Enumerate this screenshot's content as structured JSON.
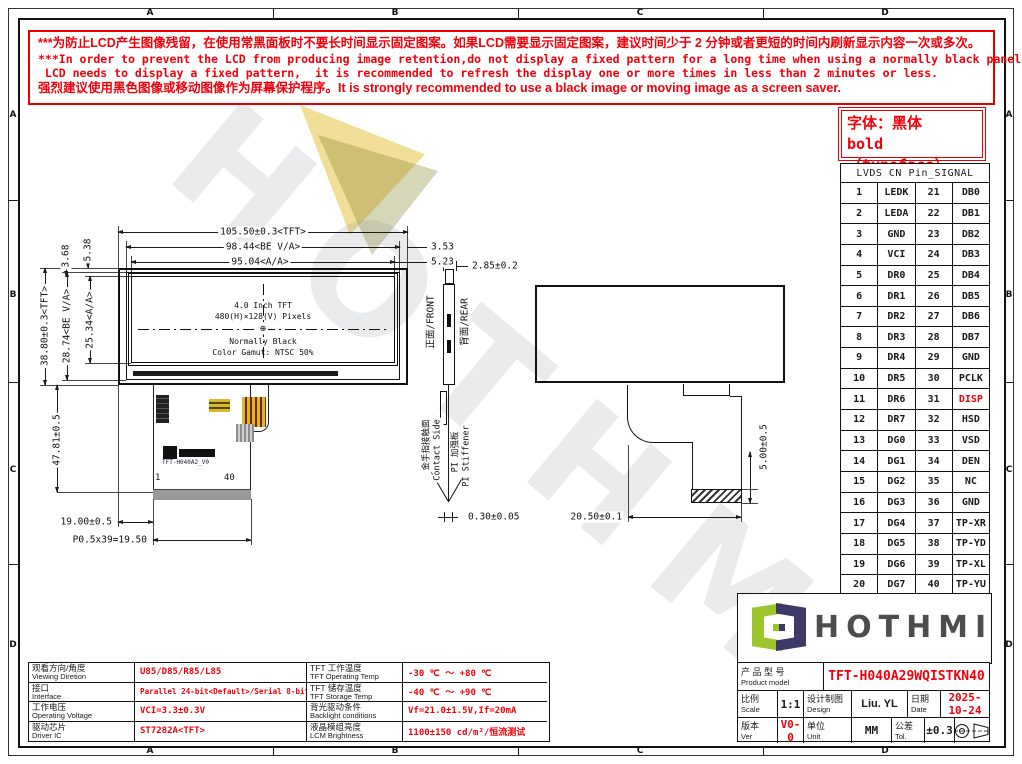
{
  "sheet": {
    "zones": [
      "A",
      "B",
      "C",
      "D"
    ]
  },
  "warning": {
    "lines": [
      "***为防止LCD产生图像残留，在使用常黑面板时不要长时间显示固定图案。如果LCD需要显示固定图案，建议时间少于 2 分钟或者更短的时间内刷新显示内容一次或多次。",
      "***In order to prevent the LCD from producing image retention,do not display a fixed pattern for a long time when using a normally black panel.If the",
      " LCD needs to display a fixed pattern,  it is recommended to refresh the display one or more times in less than 2 minutes or less.",
      "强烈建议使用黑色图像或移动图像作为屏幕保护程序。It is strongly recommended to use a black image or moving image as a screen saver."
    ]
  },
  "font_note": {
    "line1": "字体：黑体",
    "line2": "bold（typeface）"
  },
  "pin_table": {
    "title": "LVDS CN Pin_SIGNAL",
    "rows": [
      {
        "no1": "1",
        "sig1": "LEDK",
        "no2": "21",
        "sig2": "DB0"
      },
      {
        "no1": "2",
        "sig1": "LEDA",
        "no2": "22",
        "sig2": "DB1"
      },
      {
        "no1": "3",
        "sig1": "GND",
        "no2": "23",
        "sig2": "DB2"
      },
      {
        "no1": "4",
        "sig1": "VCI",
        "no2": "24",
        "sig2": "DB3"
      },
      {
        "no1": "5",
        "sig1": "DR0",
        "no2": "25",
        "sig2": "DB4"
      },
      {
        "no1": "6",
        "sig1": "DR1",
        "no2": "26",
        "sig2": "DB5"
      },
      {
        "no1": "7",
        "sig1": "DR2",
        "no2": "27",
        "sig2": "DB6"
      },
      {
        "no1": "8",
        "sig1": "DR3",
        "no2": "28",
        "sig2": "DB7"
      },
      {
        "no1": "9",
        "sig1": "DR4",
        "no2": "29",
        "sig2": "GND"
      },
      {
        "no1": "10",
        "sig1": "DR5",
        "no2": "30",
        "sig2": "PCLK"
      },
      {
        "no1": "11",
        "sig1": "DR6",
        "no2": "31",
        "sig2": "DISP",
        "red2": true
      },
      {
        "no1": "12",
        "sig1": "DR7",
        "no2": "32",
        "sig2": "HSD"
      },
      {
        "no1": "13",
        "sig1": "DG0",
        "no2": "33",
        "sig2": "VSD"
      },
      {
        "no1": "14",
        "sig1": "DG1",
        "no2": "34",
        "sig2": "DEN"
      },
      {
        "no1": "15",
        "sig1": "DG2",
        "no2": "35",
        "sig2": "NC"
      },
      {
        "no1": "16",
        "sig1": "DG3",
        "no2": "36",
        "sig2": "GND"
      },
      {
        "no1": "17",
        "sig1": "DG4",
        "no2": "37",
        "sig2": "TP-XR"
      },
      {
        "no1": "18",
        "sig1": "DG5",
        "no2": "38",
        "sig2": "TP-YD"
      },
      {
        "no1": "19",
        "sig1": "DG6",
        "no2": "39",
        "sig2": "TP-XL"
      },
      {
        "no1": "20",
        "sig1": "DG7",
        "no2": "40",
        "sig2": "TP-YU"
      }
    ]
  },
  "front_view": {
    "dims": {
      "w_tft": "105.50±0.3<TFT>",
      "w_be": "98.44<BE V/A>",
      "w_aa": "95.04<A/A>",
      "off1": "3.53",
      "off2": "5.23",
      "t1": "5.38",
      "t2": "3.68",
      "h_tft": "38.80±0.3<TFT>",
      "h_be": "28.74<BE V/A>",
      "h_aa": "25.34<A/A>",
      "fpc_len": "47.81±0.5",
      "fpc_off": "19.00±0.5",
      "pitch": "P0.5x39=19.50"
    },
    "screen": {
      "l1": "4.0 Inch TFT",
      "l2": "480(H)×128(V) Pixels",
      "l3": "Normally Black",
      "l4": "Color Gamut: NTSC 50%",
      "center_mark": "⊕"
    },
    "fpc": {
      "part": "TFT-H040A2_V0",
      "pin_first": "1",
      "pin_last": "40"
    }
  },
  "side_view": {
    "dims": {
      "thk": "2.85±0.2",
      "fpc_thk": "0.30±0.05"
    },
    "labels": {
      "front": "正面/FRONT",
      "rear": "背面/REAR",
      "contact_cn": "金手指接触面",
      "contact_en": "Contact Side",
      "pi_cn": "PI 加强板",
      "pi_en": "PI Stiffener"
    }
  },
  "rear_view": {
    "dims": {
      "finger": "5.00±0.5",
      "fpc_w": "20.50±0.1"
    }
  },
  "logo": {
    "name": "HOTHMI"
  },
  "title_block": {
    "product_cn": "产 品 型 号",
    "product_en": "Product model",
    "model": "TFT-H040A29WQISTKN40",
    "scale_cn": "比例",
    "scale_en": "Scale",
    "scale": "1:1",
    "design_cn": "设计制图",
    "design_en": "Design",
    "designer": "Liu. YL",
    "date_cn": "日期",
    "date_en": "Date",
    "date": "2025-10-24",
    "ver_cn": "版本",
    "ver_en": "Ver",
    "ver": "V0-0",
    "unit_cn": "单位",
    "unit_en": "Unit",
    "unit": "MM",
    "tol_cn": "公差",
    "tol_en": "Tol.",
    "tol": "±0.3"
  },
  "spec_table": {
    "rows": [
      {
        "cn": "观看方向/角度",
        "en": "Viewing Diretion",
        "val": "U85/D85/R85/L85",
        "cn2": "TFT 工作温度",
        "en2": "TFT Operating Temp",
        "val2": "-30 ℃ ～ +80 ℃"
      },
      {
        "cn": "接口",
        "en": "Interface",
        "val": "Parallel 24-bit<Default>/Serial 8-bit RGB",
        "small": true,
        "cn2": "TFT 储存温度",
        "en2": "TFT Storage Temp",
        "val2": "-40 ℃ ～ +90 ℃"
      },
      {
        "cn": "工作电压",
        "en": "Operating Voltage",
        "val": "VCI=3.3±0.3V",
        "cn2": "背光驱动条件",
        "en2": "Backlight conditions",
        "val2": "Vf=21.0±1.5V,If=20mA"
      },
      {
        "cn": "驱动芯片",
        "en": "Driver IC",
        "val": "ST7282A<TFT>",
        "cn2": "液晶模组亮度",
        "en2": "LCM Brightness",
        "val2": "1100±150 cd/m²/恒流测试"
      }
    ]
  },
  "watermark": {
    "text": "HOTHMI"
  }
}
